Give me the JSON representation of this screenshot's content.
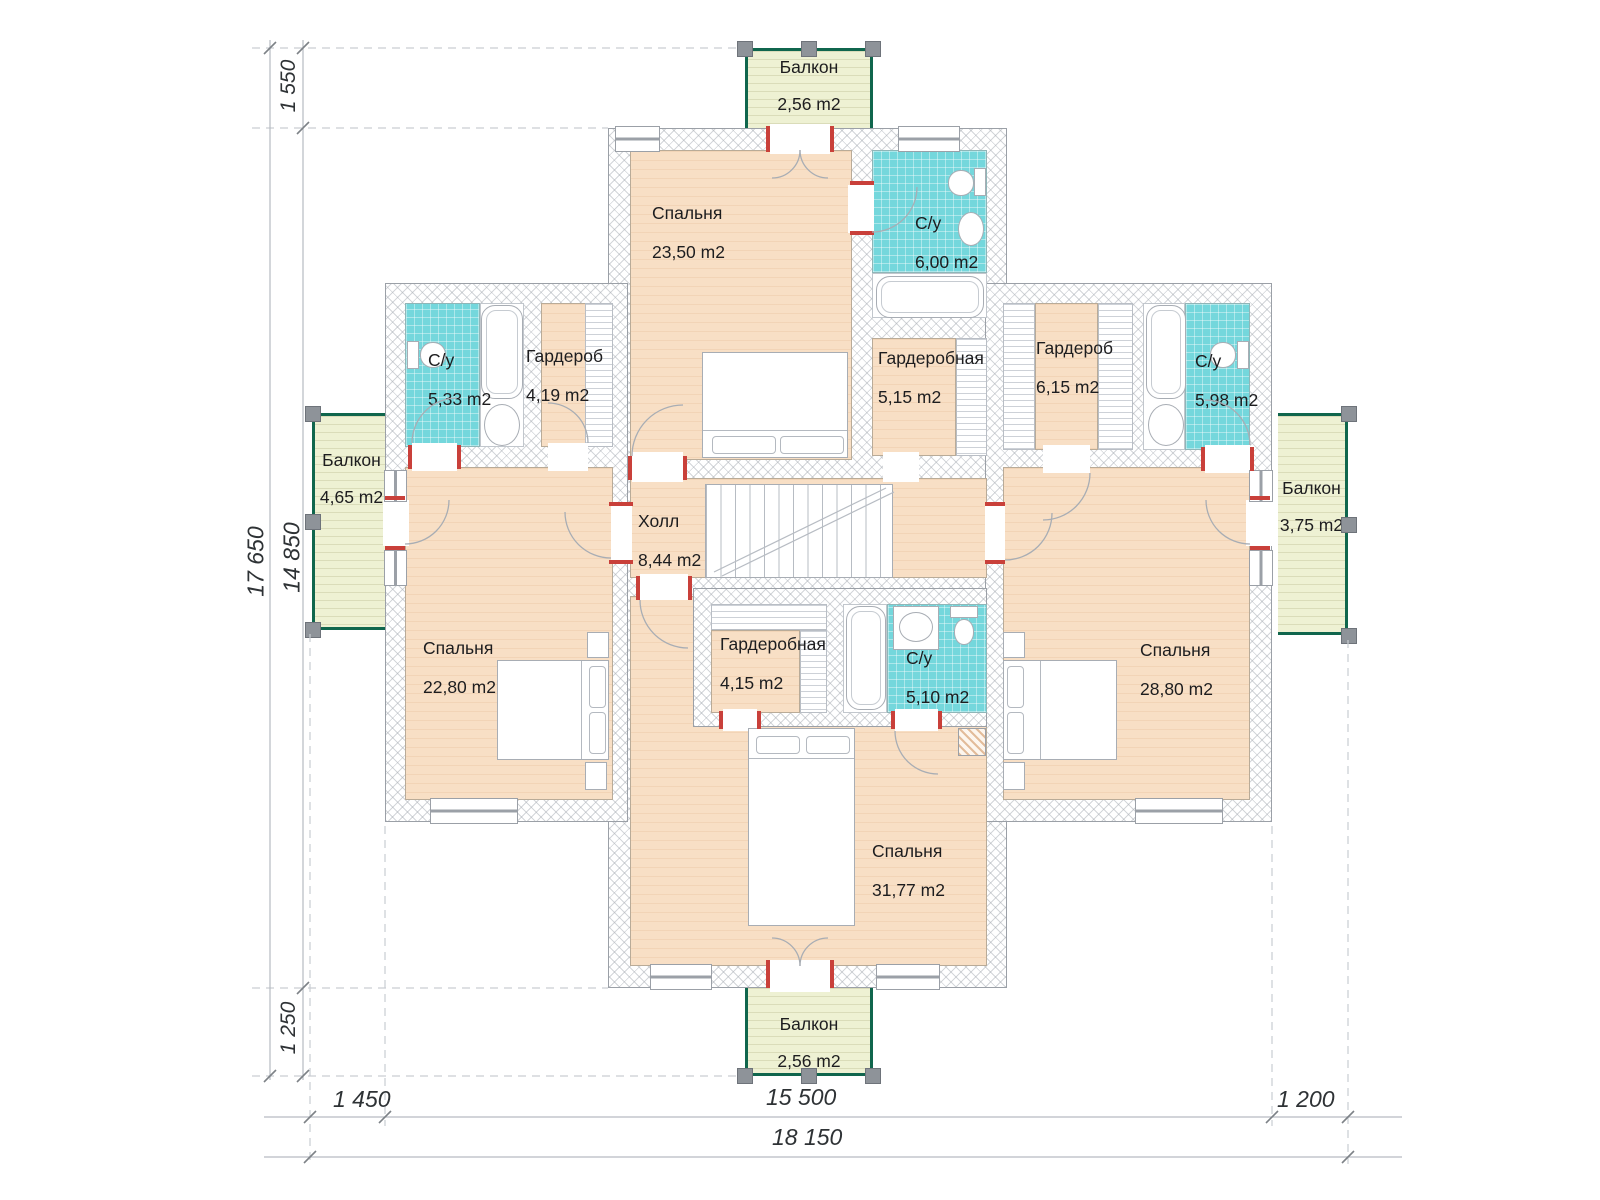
{
  "rooms": {
    "bedroom_top": {
      "name": "Спальня",
      "area": "23,50 m2"
    },
    "bathroom_top": {
      "name": "С/у",
      "area": "6,00 m2"
    },
    "dressing_top": {
      "name": "Гардеробная",
      "area": "5,15 m2"
    },
    "bathroom_left": {
      "name": "С/у",
      "area": "5,33 m2"
    },
    "wardrobe_left": {
      "name": "Гардероб",
      "area": "4,19 m2"
    },
    "wardrobe_right": {
      "name": "Гардероб",
      "area": "6,15 m2"
    },
    "bathroom_right": {
      "name": "С/у",
      "area": "5,98 m2"
    },
    "hall": {
      "name": "Холл",
      "area": "8,44 m2"
    },
    "bedroom_left": {
      "name": "Спальня",
      "area": "22,80 m2"
    },
    "bedroom_right": {
      "name": "Спальня",
      "area": "28,80 m2"
    },
    "dressing_bottom": {
      "name": "Гардеробная",
      "area": "4,15 m2"
    },
    "bathroom_bottom": {
      "name": "С/у",
      "area": "5,10 m2"
    },
    "bedroom_bottom": {
      "name": "Спальня",
      "area": "31,77 m2"
    },
    "balcony_top": {
      "name": "Балкон",
      "area": "2,56 m2"
    },
    "balcony_left": {
      "name": "Балкон",
      "area": "4,65 m2"
    },
    "balcony_right": {
      "name": "Балкон",
      "area": "3,75 m2"
    },
    "balcony_bottom": {
      "name": "Балкон",
      "area": "2,56 m2"
    }
  },
  "dimensions": {
    "vertical_total": "17 650",
    "vertical_main": "14 850",
    "vertical_top": "1 550",
    "vertical_bottom": "1 250",
    "horizontal_left": "1 450",
    "horizontal_main": "15 500",
    "horizontal_right": "1 200",
    "horizontal_total": "18 150"
  },
  "colors": {
    "room_floor": "#f8dfc5",
    "wet_floor": "#74d7dc",
    "balcony_floor": "#eef1d3",
    "balcony_frame": "#10664d",
    "wall_outline": "#9ba0a7",
    "door_accent": "#c9403a",
    "dimension_text": "#2e3235"
  }
}
